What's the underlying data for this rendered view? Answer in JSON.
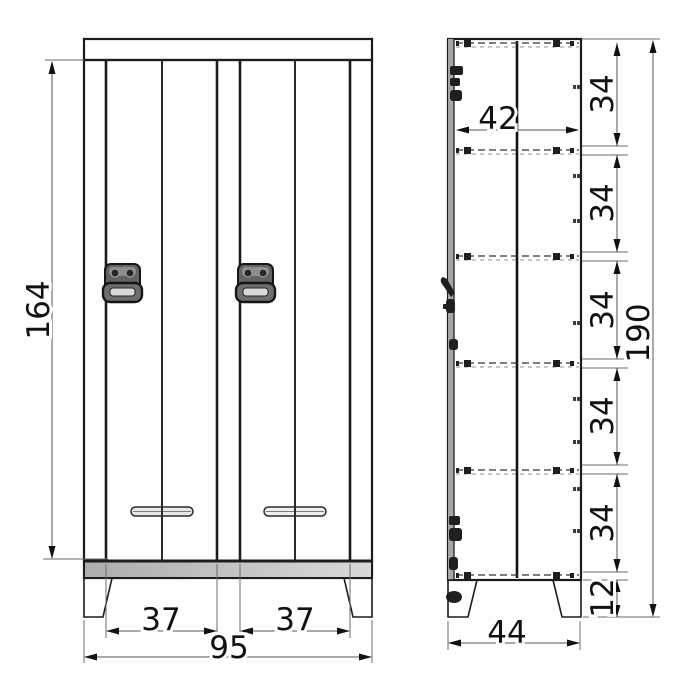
{
  "diagram": {
    "type": "furniture-technical-drawing",
    "subject": "two-door locker cabinet, front and side elevation with dimensions",
    "background_color": "#ffffff",
    "line_color": "#1c1c1c",
    "dimension_text_color": "#111111",
    "panel_fill_light": "#f5f5f5",
    "panel_fill_dark": "#b5b5b5",
    "views": {
      "front": {
        "label": "front-view",
        "dims": {
          "door_height": "164",
          "left_door_width": "37",
          "right_door_width": "37",
          "overall_width": "95"
        }
      },
      "side": {
        "label": "side-view",
        "dims": {
          "inner_depth": "42",
          "shelf_spacings": [
            "34",
            "34",
            "34",
            "34",
            "34"
          ],
          "leg_height": "12",
          "overall_height": "190",
          "overall_depth": "44"
        }
      }
    }
  }
}
